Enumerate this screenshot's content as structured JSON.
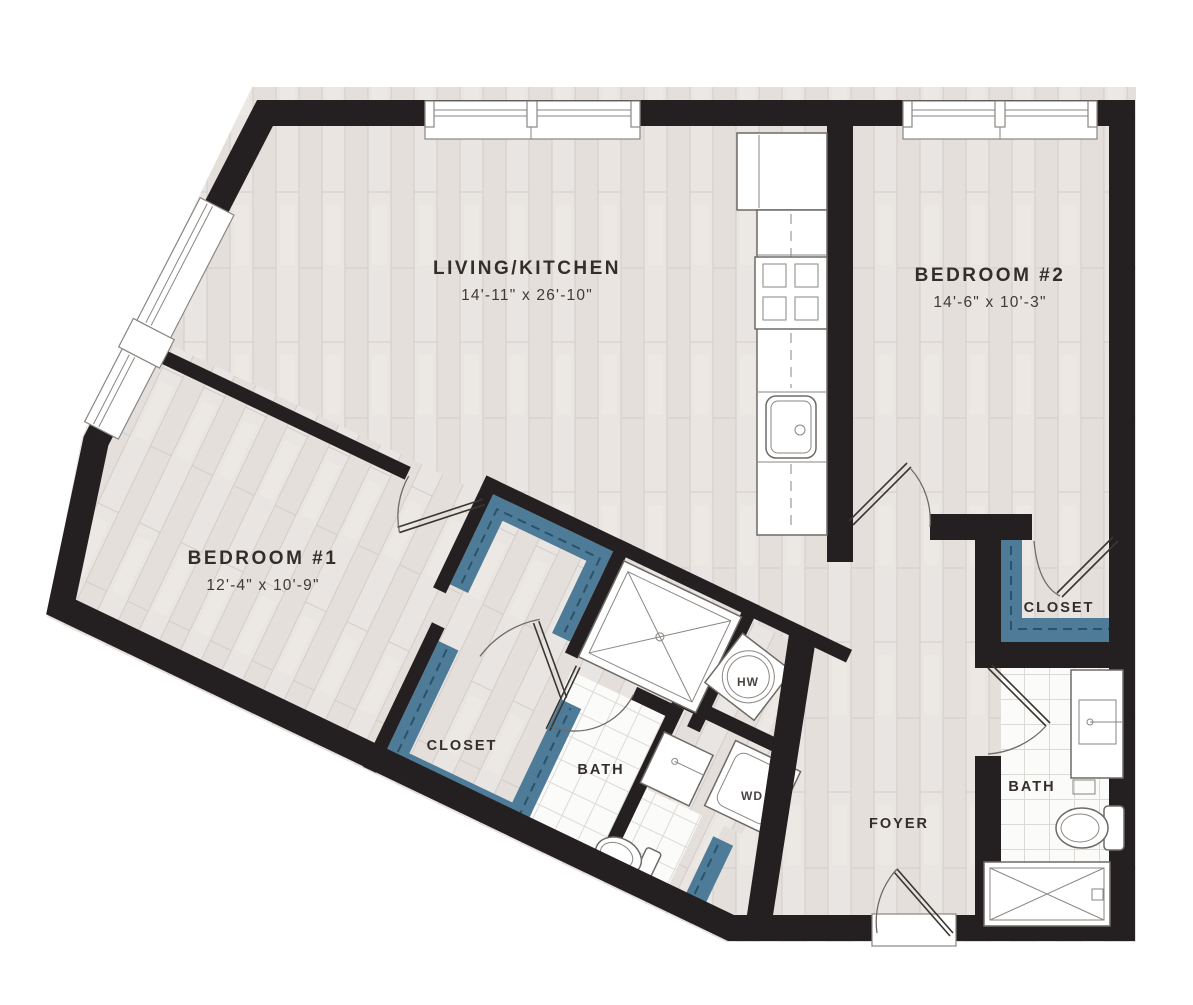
{
  "plan": {
    "rooms": {
      "living_kitchen": {
        "label": "LIVING/KITCHEN",
        "dims": "14'-11\" x 26'-10\""
      },
      "bedroom_2": {
        "label": "BEDROOM #2",
        "dims": "14'-6\" x 10'-3\""
      },
      "bedroom_1": {
        "label": "BEDROOM #1",
        "dims": "12'-4\" x 10'-9\""
      },
      "closet_bedroom_1": {
        "label": "CLOSET"
      },
      "closet_bedroom_2": {
        "label": "CLOSET"
      },
      "bath_1": {
        "label": "BATH"
      },
      "bath_2": {
        "label": "BATH"
      },
      "foyer": {
        "label": "FOYER"
      }
    },
    "fixtures": {
      "water_heater": {
        "label": "HW"
      },
      "washer_dryer": {
        "label": "WD"
      }
    },
    "colors": {
      "wall": "#242021",
      "closet_accent": "#4e7b97",
      "closet_dash": "#1f4a63",
      "floor": "#e8e4e1",
      "floor_line": "#d3cdc8",
      "tile_line": "#dcdad6",
      "label": "#332e2b"
    }
  }
}
